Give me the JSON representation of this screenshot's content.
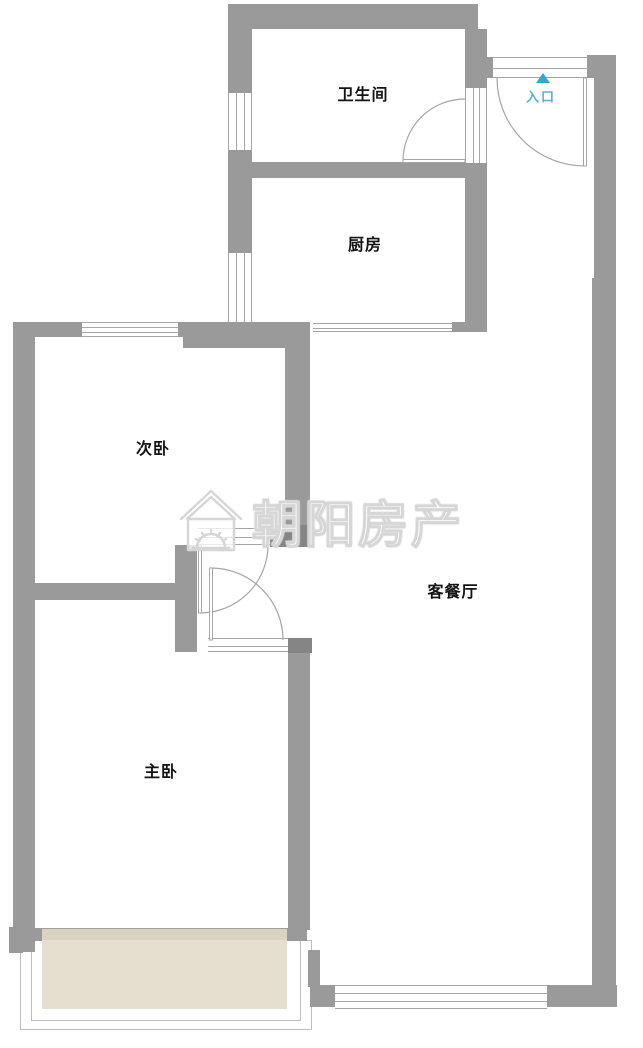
{
  "floorplan": {
    "rooms": [
      {
        "id": "bathroom",
        "label": "卫生间"
      },
      {
        "id": "kitchen",
        "label": "厨房"
      },
      {
        "id": "second-bedroom",
        "label": "次卧"
      },
      {
        "id": "master-bedroom",
        "label": "主卧"
      },
      {
        "id": "living-dining",
        "label": "客餐厅"
      }
    ],
    "entrance": {
      "label": "入口",
      "arrow_icon": "triangle-up"
    },
    "watermark": {
      "brand_text": "朝阳房产",
      "logo_icon": "house-sun-logo"
    },
    "colors": {
      "wall": "#9a9a9a",
      "wall_dark": "#858585",
      "line": "#a6a6a6",
      "line_light": "#bdbdbd",
      "balcony_floor": "#e4dfce",
      "balcony_floor_edge": "#d9d3c0",
      "entrance_blue": "#35a4d8",
      "entrance_text": "#5fadcd",
      "label": "#141414"
    }
  }
}
